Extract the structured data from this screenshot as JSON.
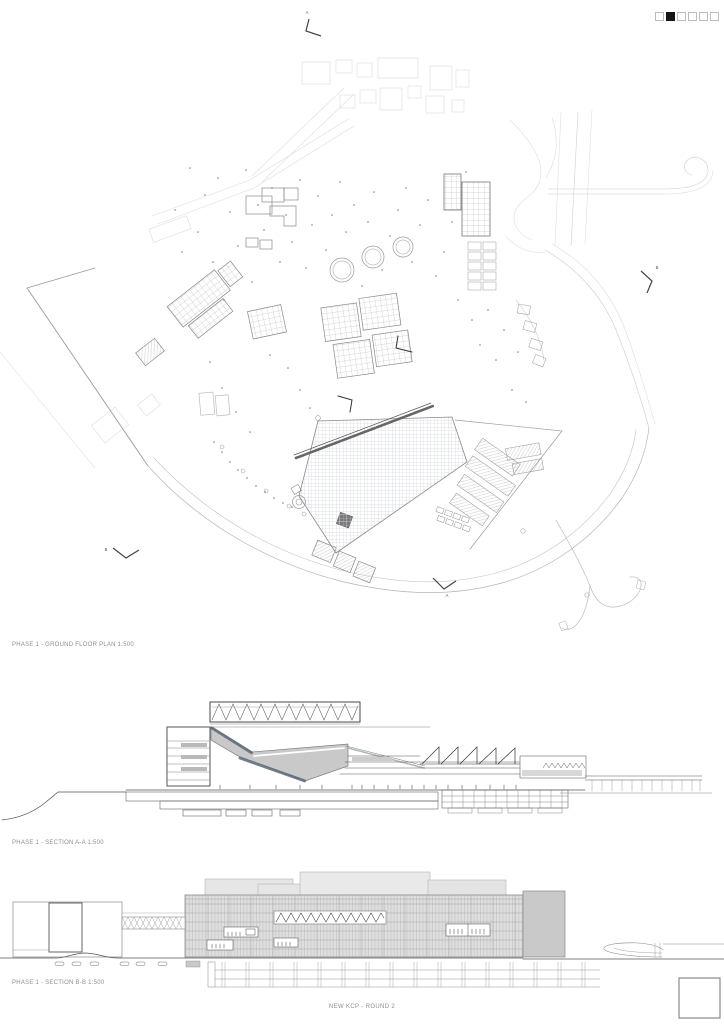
{
  "sheet": {
    "title": "NEW KCP - ROUND 2",
    "page_indicator": {
      "total": 6,
      "active_index": 1
    }
  },
  "drawings": {
    "plan": {
      "label": "PHASE 1 - GROUND FLOOR PLAN 1:500"
    },
    "section_a": {
      "label": "PHASE 1 - SECTION A-A 1:500"
    },
    "section_b": {
      "label": "PHASE 1 - SECTION B-B 1:500"
    }
  },
  "section_markers": {
    "top": "A",
    "right": "B",
    "bottom": "A",
    "left": "B"
  },
  "colors": {
    "line_dark": "#444444",
    "line_mid": "#8a8a8a",
    "line_light": "#d8d8d8",
    "section_mass_gray": "#c9c9c9",
    "elevation_gray": "#dedede",
    "plaza_grid": "#bcc3ca",
    "fringe_blue_gray": "#5a6a78",
    "indicator_active": "#151515"
  }
}
